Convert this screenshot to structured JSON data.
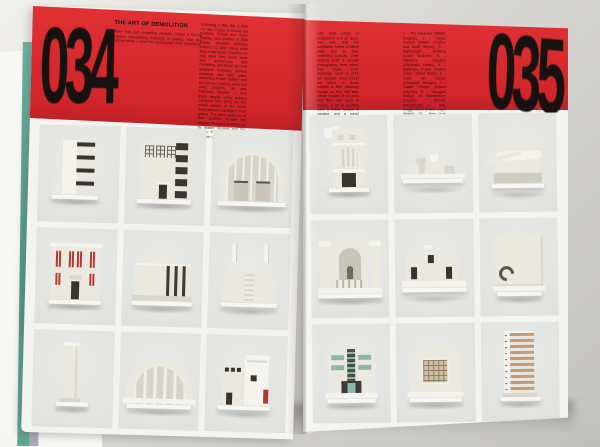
{
  "spread": {
    "left": {
      "page_number": "034",
      "title": "THE ART OF DEMOLITION",
      "intro": "More than just modelling wizards, Chisel & Mouse capture era-defining buildings in plaster, wire and etched metal — and then photograph them beautifully.",
      "column_text": "Sounding a little like a kids' TV duo, Chisel & Mouse are brothers, Robert and Gavin Paisley, who packed in their solidly sensible software careers to start doing what they really loved. It turned out that what they loved most was architecture and modelling, and these are now available including famous buildings and their walls. Battersea Power Station and the Hoover building were two early projects, as was Highbury Stadium — and that's despite being lifelong Liverpool fans (they are the proud owners of the club's most famous manager's front gates). The latest additions to their portfolio include the original Bauhaus building (2) by Walter Gropius and the Fagus Factory (1). Robert Heather writes."
    },
    "right": {
      "page_number": "035",
      "column_text": "Lots stark crisps of modernism and art deco, and sells that the worldwide future of Mies' walls and let their modelling pursuits. Their starting point is usually photography, from which they create CAD drawings, used to print 3D models. They found the fabric of these models a little plasticky though, so they now take silicon moulds of the print and then cast them in plaster. A lot of sanding later, a model facade is created, and a metal mesh takes form. The final models are also created in pewter, going from a ghostly buff. Since they started, they've been approached by the likes of the Frank Lloyd Wright Foundation and recently the London Zoo, and are now working on commissions for everything from offices to hotels.",
      "captions": "1 – The Bauhaus (Walter Gropius), 2 – Fagus Factory (Walter Gropius and Adolf Meyer), 3 – Wainwright Building (Louis Sullivan), 4 – Highbury Stadium (Archibald Leitch), 5 – Battersea Power Station (Giles Gilbert Scott), 6 – Casa del Fascio (Giuseppe Terragni), 7 – Castle Drogo (Edwin Lutyens), 8 – Glasgow School of Architecture (Charles Rennie Mackintosh), 9 – Villa Guggenheim (Frank Lloyd Wright), 10 – New York Guggenheim (Frank Lloyd Wright), 11 – Hoover Building (Wallis Gilbert), 12 – Michigan Central Station, 13 – Einstein Tower (Erich Mendelsohn), 14 – Tower models from Azerbaijan."
    }
  },
  "models": {
    "left": [
      "stepped-facade",
      "bauhaus-building",
      "grand-arch-hall",
      "red-window-theatre",
      "striped-hall",
      "battersea-power-station",
      "monolith-tower",
      "ribbed-arch-stadium",
      "de-stijl-house"
    ],
    "right": [
      "arch-window-house",
      "sprawling-museum",
      "layered-disc-museum",
      "arched-niche-facade",
      "blocky-village",
      "spiral-relief-slab",
      "teal-deco-cinema",
      "lattice-window-station",
      "brick-tower"
    ]
  },
  "colors": {
    "cover_red": "#d0252a",
    "ink_black": "#17120f",
    "page_white": "#f3f3f0",
    "photo_cell_grey": "#e0e2df",
    "model_cream": "#ebe8e0",
    "accent_red": "#b5382f",
    "accent_teal": "#8fb6ab",
    "accent_brick": "#c19b77",
    "book_edge_teal": "#5aa896"
  }
}
